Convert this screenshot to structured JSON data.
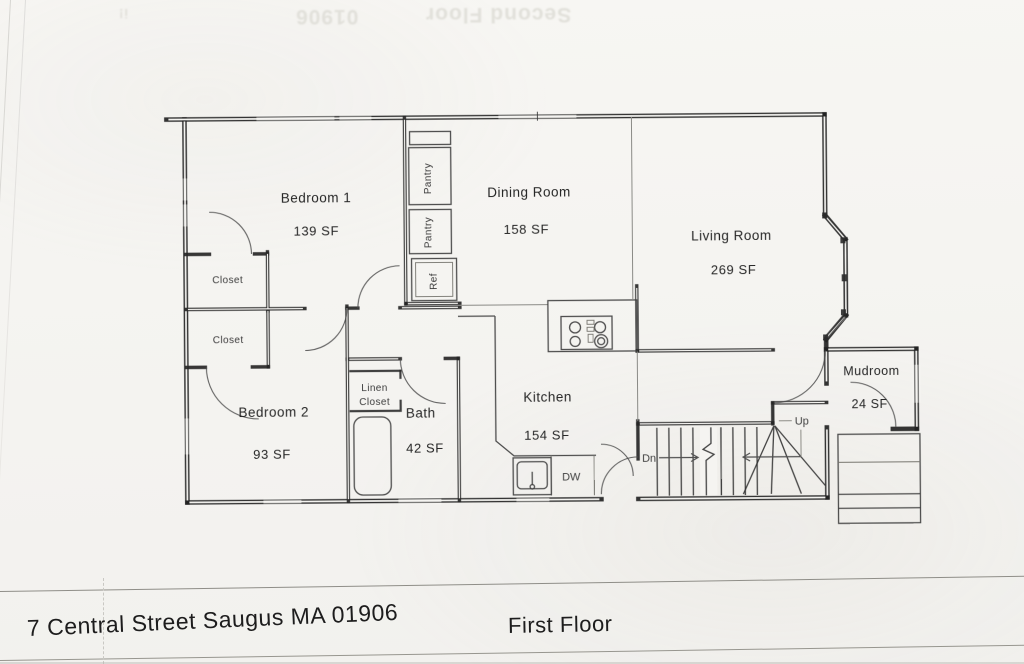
{
  "colors": {
    "paper": "#f5f4f1",
    "ink": "#262626",
    "faint_bleed": "#e1e0da",
    "title_line": "#8f8e88"
  },
  "bleed_through": {
    "zip": "01906",
    "label": "Second Floor",
    "mark": "i!"
  },
  "rooms": [
    {
      "name": "Bedroom 1",
      "area": "139 SF"
    },
    {
      "name": "Dining Room",
      "area": "158 SF"
    },
    {
      "name": "Living Room",
      "area": "269 SF"
    },
    {
      "name": "Bedroom 2",
      "area": "93 SF"
    },
    {
      "name": "Bath",
      "area": "42 SF"
    },
    {
      "name": "Kitchen",
      "area": "154 SF"
    },
    {
      "name": "Mudroom",
      "area": "24 SF"
    }
  ],
  "closets": {
    "closet_a": "Closet",
    "closet_b": "Closet",
    "linen_line1": "Linen",
    "linen_line2": "Closet"
  },
  "fixtures": {
    "pantry_a": "Pantry",
    "pantry_b": "Pantry",
    "refrigerator": "Ref",
    "dishwasher": "DW"
  },
  "stairs": {
    "down": "Dn",
    "up": "Up"
  },
  "title_block": {
    "address": "7 Central Street Saugus MA 01906",
    "floor_label": "First Floor"
  }
}
